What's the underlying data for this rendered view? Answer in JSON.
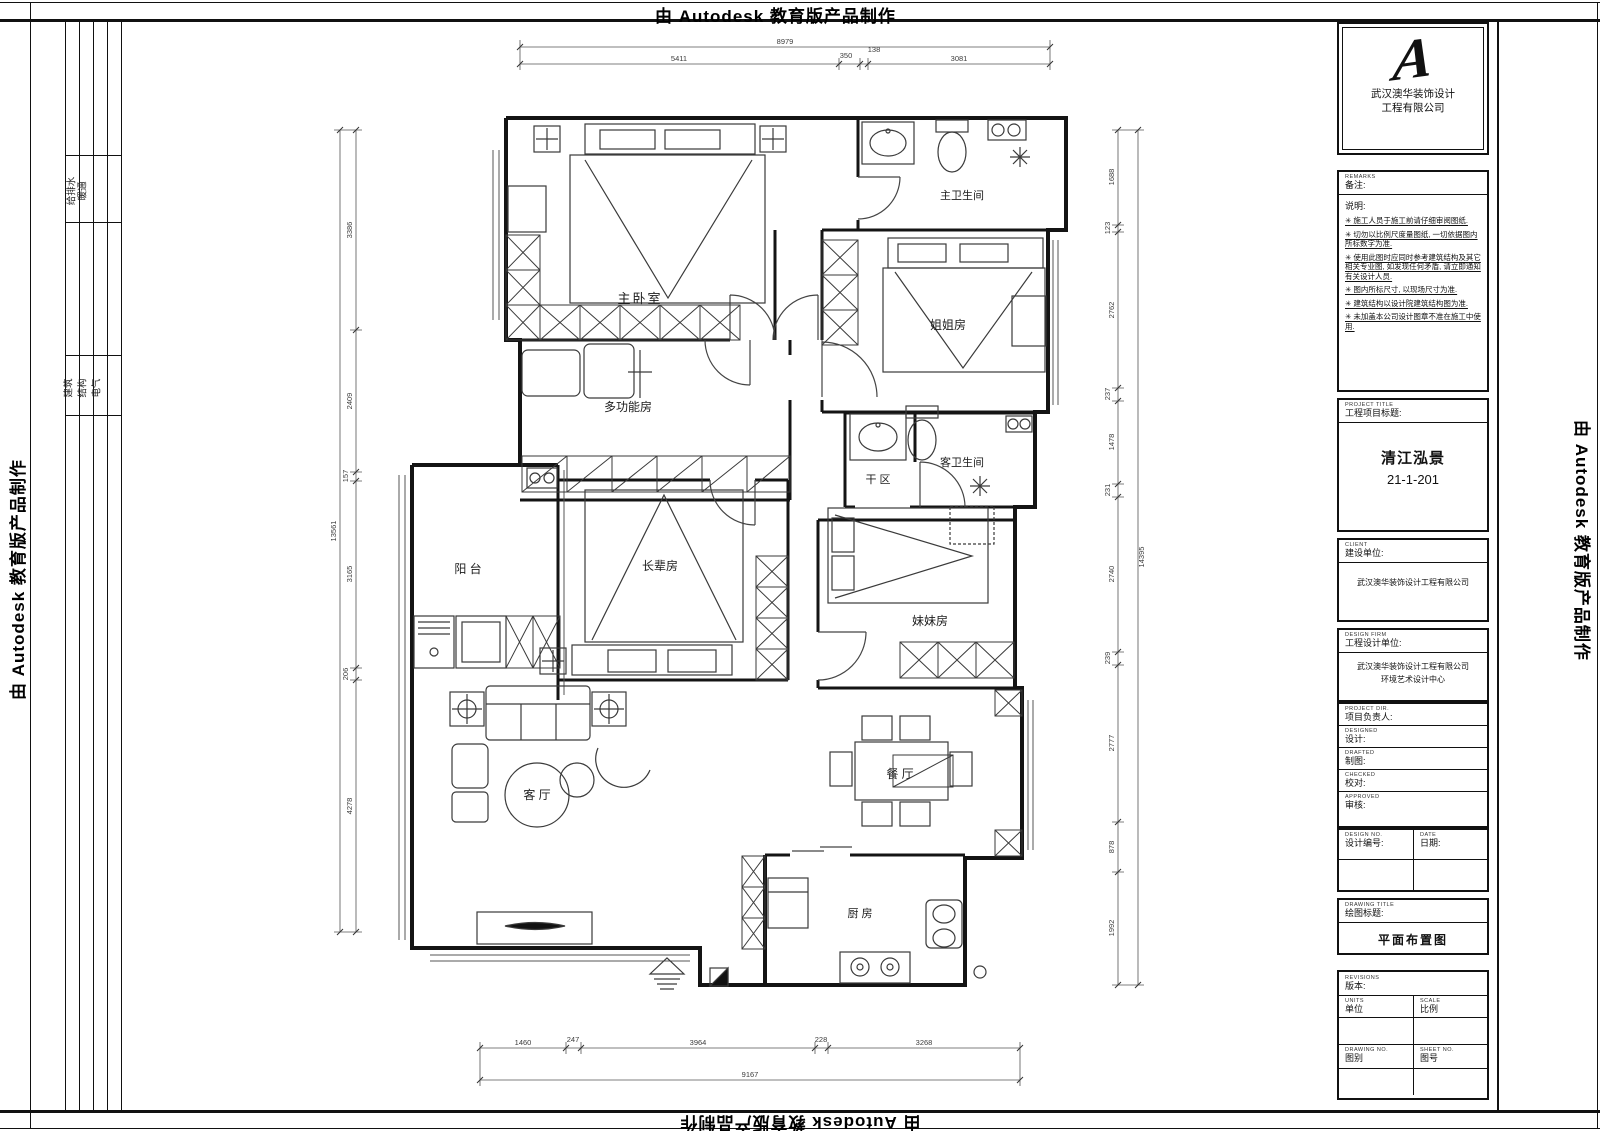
{
  "banner": {
    "text": "由 Autodesk 教育版产品制作"
  },
  "frame_strip": {
    "group1": [
      "给排水",
      "暖通"
    ],
    "group2": [
      "建筑",
      "结构",
      "电气"
    ]
  },
  "rooms": {
    "master_bedroom": "主卧室",
    "master_bath": "主卫生间",
    "sister_elder": "姐姐房",
    "multi_function": "多功能房",
    "dry_area": "干 区",
    "guest_bath": "客卫生间",
    "balcony": "阳 台",
    "elder_room": "长辈房",
    "sister_younger": "妹妹房",
    "living": "客 厅",
    "dining": "餐 厅",
    "kitchen": "厨 房"
  },
  "dims": {
    "top_total": "8979",
    "top_segments": [
      "5411",
      "350",
      "138",
      "3081"
    ],
    "bottom_segments": [
      "1460",
      "247",
      "3964",
      "228",
      "3268"
    ],
    "bottom_total": "9167",
    "left_total": "13561",
    "left_segments": [
      "3386",
      "2409",
      "157",
      "3165",
      "206",
      "4278"
    ],
    "right_segments": [
      "1688",
      "123",
      "2762",
      "237",
      "1478",
      "231",
      "2740",
      "239",
      "2777",
      "878",
      "1992"
    ],
    "right_total": "14395"
  },
  "title_block": {
    "company_line1": "武汉澳华装饰设计",
    "company_line2": "工程有限公司",
    "remarks_en": "REMARKS",
    "remarks_label": "备注:",
    "notes_title": "说明:",
    "notes": [
      "✳ 施工人员于施工前请仔细审阅图纸.",
      "✳ 切勿以比例尺度量图纸, 一切依据图内所标数字为准.",
      "✳ 使用此图时应同时参考建筑结构及其它相关专业图, 如发现任何矛盾, 请立即通知有关设计人员.",
      "✳ 图内所标尺寸, 以现场尺寸为准.",
      "✳ 建筑结构以设计院建筑结构图为准.",
      "✳ 未加盖本公司设计图章不准在施工中使用."
    ],
    "project_en": "PROJECT TITLE",
    "project_label": "工程项目标题:",
    "project_name": "清江泓景",
    "project_no": "21-1-201",
    "client_en": "CLIENT",
    "client_label": "建设单位:",
    "client_name": "武汉澳华装饰设计工程有限公司",
    "firm_en": "DESIGN FIRM",
    "firm_label": "工程设计单位:",
    "firm_line1": "武汉澳华装饰设计工程有限公司",
    "firm_line2": "环境艺术设计中心",
    "fields": [
      {
        "en": "PROJECT DIR.",
        "label": "项目负责人:"
      },
      {
        "en": "DESIGNED",
        "label": "设计:"
      },
      {
        "en": "DRAFTED",
        "label": "制图:"
      },
      {
        "en": "CHECKED",
        "label": "校对:"
      },
      {
        "en": "APPROVED",
        "label": "审核:"
      }
    ],
    "design_no_en": "DESIGN NO.",
    "design_no_label": "设计编号:",
    "date_en": "DATE",
    "date_label": "日期:",
    "drawing_title_en": "DRAWING TITLE",
    "drawing_title_label": "绘图标题:",
    "drawing_title": "平面布置图",
    "revisions_en": "REVISIONS",
    "revisions_label": "版本:",
    "units_en": "UNITS",
    "units_label": "单位",
    "scale_en": "SCALE",
    "scale_label": "比例",
    "drawing_no_en": "DRAWING NO.",
    "drawing_no_label": "图别",
    "sheet_no_en": "SHEET NO.",
    "sheet_no_label": "图号"
  }
}
